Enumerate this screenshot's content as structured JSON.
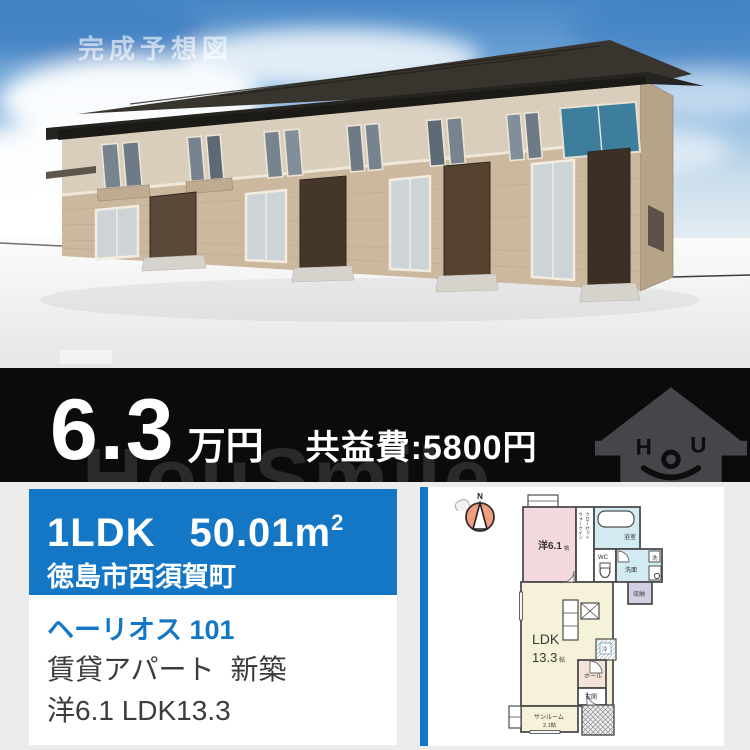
{
  "photo": {
    "watermark": "完成予想図",
    "description": "3D render of two-story rental apartment building, beige brick lower floor, cream upper floor, dark roof, blue sky with clouds"
  },
  "price_band": {
    "price_value": "6.3",
    "price_unit": "万円",
    "fee_label": "共益費:5800円",
    "brand_watermark": "HouSmile",
    "logo": {
      "eye_left": "H",
      "eye_right": "U"
    }
  },
  "listing_card": {
    "layout_type": "1LDK",
    "area_value": "50.01m",
    "area_sup": "2",
    "address": "徳島市西須賀町",
    "name": "ヘーリオス 101",
    "category": "賃貸アパート",
    "condition": "新築",
    "rooms_summary": "洋6.1 LDK13.3"
  },
  "floorplan": {
    "compass_label": "N",
    "western_room": "洋6.1",
    "tatami_unit": "帖",
    "wic_line1": "ウォークイン",
    "wic_line2": "クローゼット",
    "bath": "浴室",
    "wc": "WC",
    "washroom": "洗面",
    "laundry": "洗",
    "storage": "収納",
    "ldk": "LDK",
    "ldk_size": "13.3",
    "fridge": "冷",
    "hall": "ホール",
    "entrance": "玄関",
    "sunroom": "サンルーム",
    "sunroom_size": "2.1帖"
  },
  "colors": {
    "accent_blue": "#1377c5",
    "band_black": "#0b0b0b",
    "room_pink": "#f3d9de",
    "room_cream": "#f6f2da",
    "room_lightblue": "#d2eaf2",
    "room_lavender": "#d2cfe2",
    "room_peach": "#f4e3d8",
    "compass_orange": "#ef9f7d"
  }
}
